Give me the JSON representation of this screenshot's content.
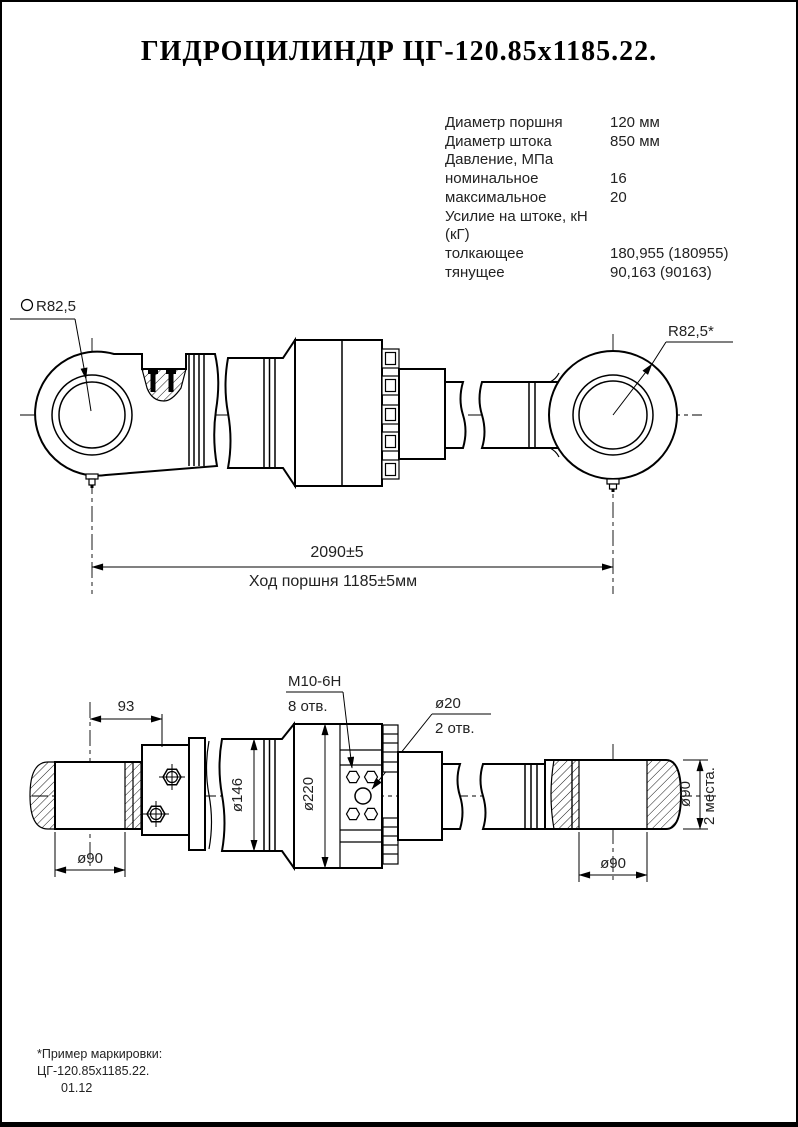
{
  "colors": {
    "background": "#ffffff",
    "line": "#000000",
    "text": "#1d1d1d"
  },
  "title": "ГИДРОЦИЛИНДР ЦГ-120.85х1185.22.",
  "specs": {
    "rows": [
      {
        "label": "Диаметр поршня",
        "value": "120 мм"
      },
      {
        "label": "Диаметр штока",
        "value": "850 мм"
      },
      {
        "label": "Давление, МПа",
        "value": ""
      },
      {
        "label": "номинальное",
        "value": "16"
      },
      {
        "label": "максимальное",
        "value": "20"
      },
      {
        "label": "Усилие на штоке, кН (кГ)",
        "value": ""
      },
      {
        "label": "толкающее",
        "value": "180,955 (180955)"
      },
      {
        "label": "тянущее",
        "value": "90,163 (90163)"
      }
    ]
  },
  "side_view": {
    "sphere_radius_label": "R82,5",
    "radius_label": "R82,5*",
    "overall_length": "2090±5",
    "stroke_label": "Ход поршня 1185±5мм"
  },
  "top_view": {
    "offset_93": "93",
    "pin_dia_left": "ø90",
    "tube_dia": "ø146",
    "body_dia": "ø220",
    "thread_spec": "М10-6Н",
    "thread_holes": "8 отв.",
    "port_dia": "ø20",
    "port_holes": "2 отв.",
    "pin_dia_right": "ø90",
    "pin_dia_right_side": "ø90",
    "places_note": "2 места."
  },
  "footnote": {
    "line1": "*Пример маркировки:",
    "line2": "ЦГ-120.85х1185.22.",
    "line3": "01.12"
  }
}
